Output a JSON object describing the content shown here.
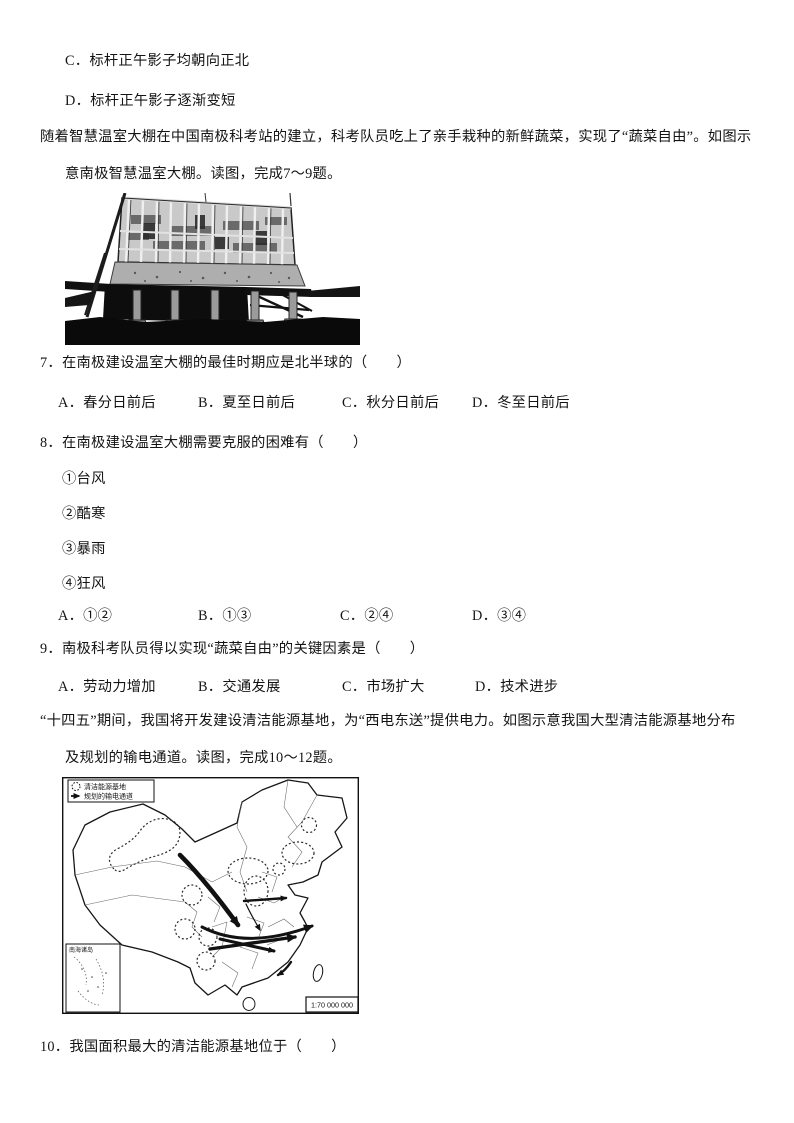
{
  "prior_options": [
    "C．标杆正午影子均朝向正北",
    "D．标杆正午影子逐渐变短"
  ],
  "passage_greenhouse": {
    "line1": "随着智慧温室大棚在中国南极科考站的建立，科考队员吃上了亲手栽种的新鲜蔬菜，实现了“蔬菜自由”。如图示",
    "line2": "意南极智慧温室大棚。读图，完成7～9题。"
  },
  "figure_greenhouse": {
    "description": "南极智慧温室大棚照片"
  },
  "q7": {
    "stem": "7．在南极建设温室大棚的最佳时期应是北半球的（　　）",
    "options": [
      "A．春分日前后",
      "B．夏至日前后",
      "C．秋分日前后",
      "D．冬至日前后"
    ]
  },
  "q8": {
    "stem": "8．在南极建设温室大棚需要克服的困难有（　　）",
    "items": [
      "①台风",
      "②酷寒",
      "③暴雨",
      "④狂风"
    ],
    "options": [
      "A．①②",
      "B．①③",
      "C．②④",
      "D．③④"
    ]
  },
  "q9": {
    "stem": "9．南极科考队员得以实现“蔬菜自由”的关键因素是（　　）",
    "options": [
      "A．劳动力增加",
      "B．交通发展",
      "C．市场扩大",
      "D．技术进步"
    ]
  },
  "passage_energy": {
    "line1": "“十四五”期间，我国将开发建设清洁能源基地，为“西电东送”提供电力。如图示意我国大型清洁能源基地分布",
    "line2": "及规划的输电通道。读图，完成10～12题。"
  },
  "map_figure": {
    "legend_base": "清洁能源基地",
    "legend_channel": "规划的输电通道",
    "inset_label": "南海诸岛",
    "scale": "1:70 000 000"
  },
  "q10": {
    "stem": "10．我国面积最大的清洁能源基地位于（　　）"
  }
}
